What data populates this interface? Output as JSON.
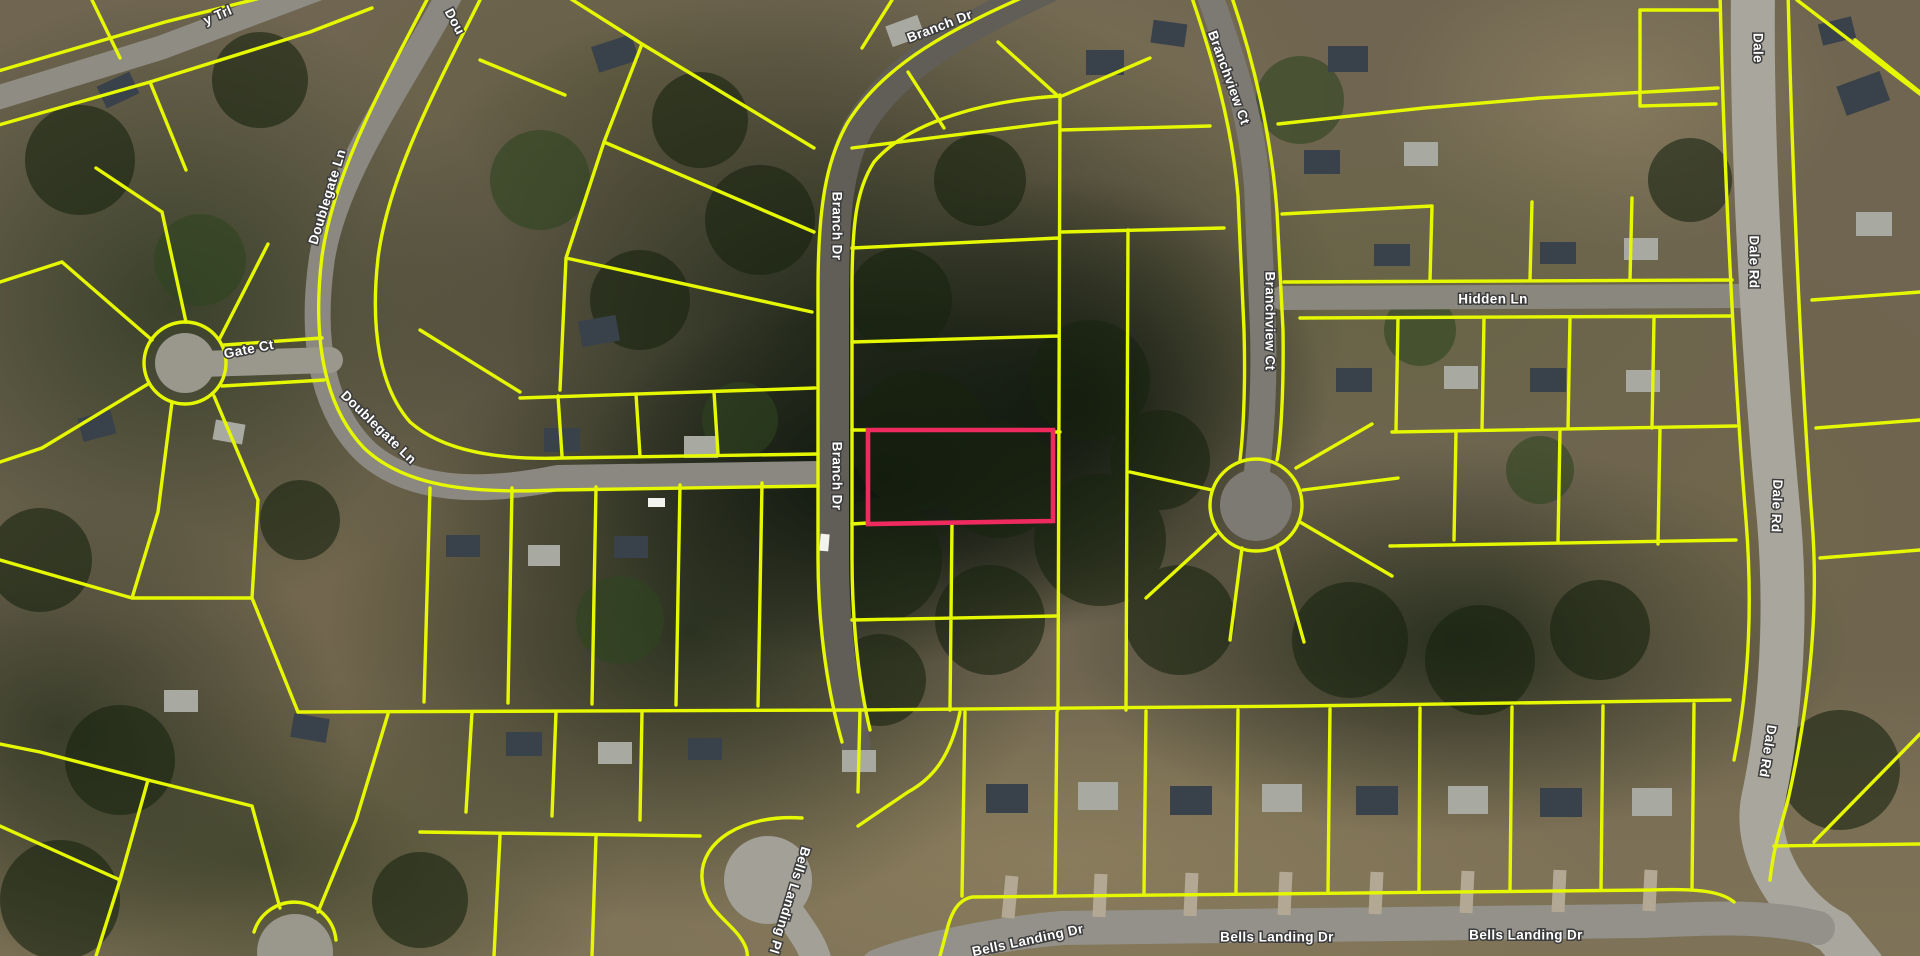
{
  "map": {
    "description": "Satellite parcel map with lot boundary overlay and one selected parcel highlighted",
    "colors": {
      "parcel_line": "#e6f800",
      "selected_parcel_outline": "#ee2a5e",
      "label_fill": "#ffffff",
      "label_halo": "#3d3d3d"
    },
    "streets_visible": [
      "Trl (partial)",
      "Doublegate Ln",
      "Branch Dr",
      "Gate Ct",
      "Branchview Ct",
      "Hidden Ln",
      "Dale Rd",
      "Bells Landing Dr",
      "Bells Landing Pl"
    ],
    "street_labels": [
      {
        "text": "y Trl"
      },
      {
        "text": "Dou"
      },
      {
        "text": "Branch Dr"
      },
      {
        "text": "Dale"
      },
      {
        "text": "Branchview Ct"
      },
      {
        "text": "Branch Dr"
      },
      {
        "text": "Doublegate Ln"
      },
      {
        "text": "Dale Rd"
      },
      {
        "text": "Gate Ct"
      },
      {
        "text": "Hidden Ln"
      },
      {
        "text": "Branchview Ct"
      },
      {
        "text": "Doublegate Ln"
      },
      {
        "text": "Branch Dr"
      },
      {
        "text": "Dale Rd"
      },
      {
        "text": "Bells Landing Pl"
      },
      {
        "text": "Dale Rd"
      },
      {
        "text": "Bells Landing Dr"
      },
      {
        "text": "Bells Landing Dr"
      },
      {
        "text": "Bells Landing Dr"
      }
    ]
  }
}
